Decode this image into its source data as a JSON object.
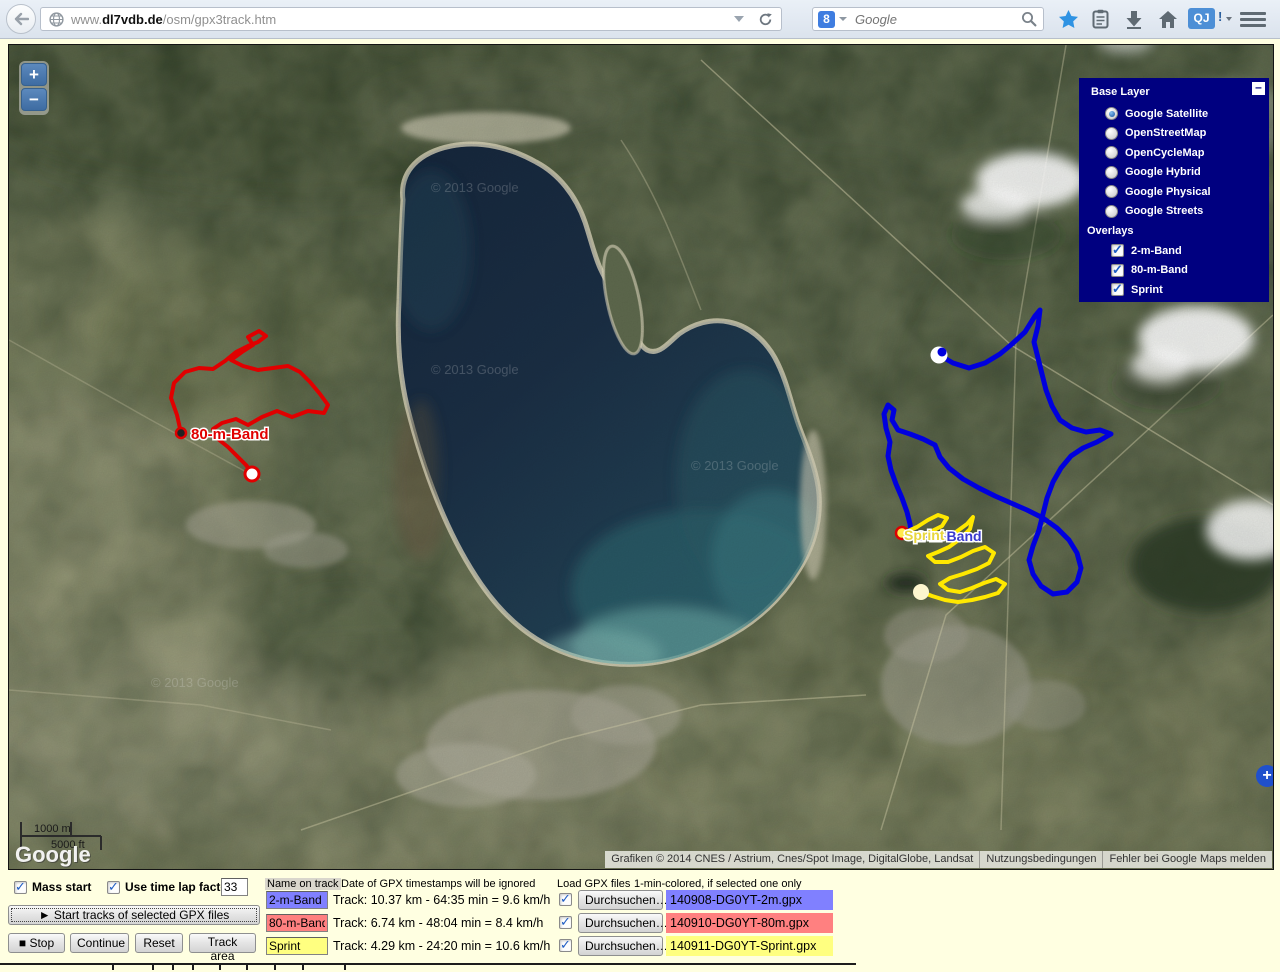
{
  "browser": {
    "url": {
      "prefix": "www.",
      "domain": "dl7vdb.de",
      "path": "/osm/gpx3track.htm"
    },
    "search": {
      "placeholder": "Google"
    },
    "addon_badge": "QJ",
    "addon_bang": "!"
  },
  "map": {
    "zoom_in": "+",
    "zoom_out": "−",
    "expand": "+",
    "scale": {
      "meters": "1000 m",
      "feet": "5000 ft"
    },
    "logo": "Google",
    "watermark": "© 2013 Google",
    "attribution": "Grafiken © 2014 CNES / Astrium, Cnes/Spot Image, DigitalGlobe, Landsat",
    "terms": "Nutzungsbedingungen",
    "report": "Fehler bei Google Maps melden",
    "track_labels": {
      "band80": "80-m-Band",
      "band2": "2-m-Band",
      "sprint": "Sprint"
    },
    "track_colors": {
      "band80": "#e00000",
      "band2": "#0000dd",
      "sprint": "#ffe800"
    }
  },
  "layer_switcher": {
    "base_title": "Base Layer",
    "base_layers": [
      {
        "label": "Google Satellite",
        "selected": true
      },
      {
        "label": "OpenStreetMap",
        "selected": false
      },
      {
        "label": "OpenCycleMap",
        "selected": false
      },
      {
        "label": "Google Hybrid",
        "selected": false
      },
      {
        "label": "Google Physical",
        "selected": false
      },
      {
        "label": "Google Streets",
        "selected": false
      }
    ],
    "overlays_title": "Overlays",
    "overlays": [
      {
        "label": "2-m-Band",
        "checked": true
      },
      {
        "label": "80-m-Band",
        "checked": true
      },
      {
        "label": "Sprint",
        "checked": true
      }
    ]
  },
  "controls": {
    "mass_start": {
      "label": "Mass start",
      "checked": true
    },
    "time_lap": {
      "label": "Use time lap factor",
      "checked": true,
      "value": "33"
    },
    "start_button": "► Start tracks of selected GPX files",
    "stop_button": "■ Stop",
    "continue_button": "Continue",
    "reset_button": "Reset",
    "track_area_button": "Track area",
    "name_header": "Name on track",
    "date_note": "Date of GPX timestamps will be ignored",
    "load_header": "Load GPX files",
    "load_note": "1-min-colored, if selected one only",
    "browse_label": "Durchsuchen…",
    "tracks": [
      {
        "name": "2-m-Band",
        "color": "#8080ff",
        "stats": "Track: 10.37 km - 64:35 min = 9.6 km/h",
        "file": "140908-DG0YT-2m.gpx",
        "checked": true
      },
      {
        "name": "80-m-Band",
        "color": "#ff8080",
        "stats": "Track: 6.74 km - 48:04 min = 8.4 km/h",
        "file": "140910-DG0YT-80m.gpx",
        "checked": true
      },
      {
        "name": "Sprint",
        "color": "#ffff80",
        "stats": "Track: 4.29 km - 24:20 min = 10.6 km/h",
        "file": "140911-DG0YT-Sprint.gpx",
        "checked": true
      }
    ]
  }
}
